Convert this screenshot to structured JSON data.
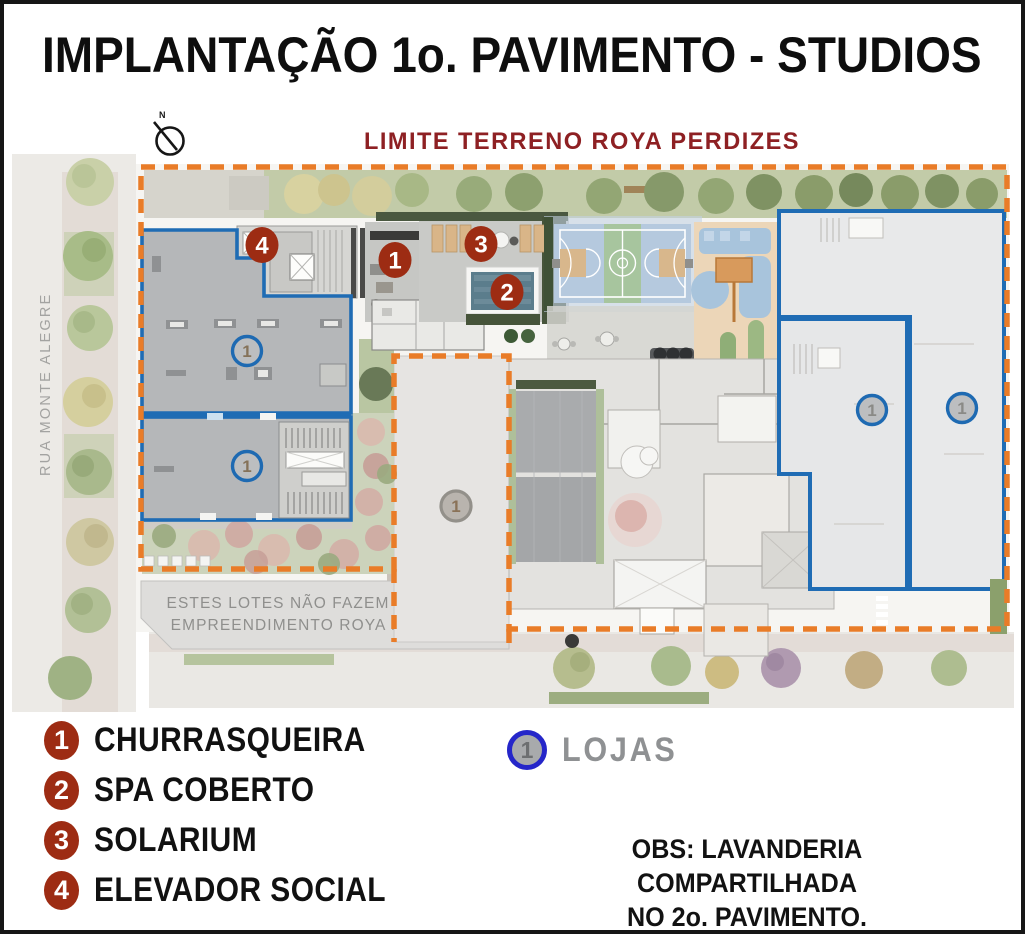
{
  "page": {
    "title": "IMPLANTAÇÃO 1o. PAVIMENTO - STUDIOS"
  },
  "plan": {
    "north_label": "N",
    "boundary_label": "LIMITE TERRENO ROYA PERDIZES",
    "street_label": "RUA MONTE ALEGRE",
    "excluded_note": {
      "line1": "ESTES LOTES NÃO FAZEM PARTE DO",
      "line2": "EMPREENDIMENTO ROYA PERDIZES"
    },
    "red_markers": [
      {
        "number": "4"
      },
      {
        "number": "1"
      },
      {
        "number": "3"
      },
      {
        "number": "2"
      }
    ],
    "shop_markers": [
      {
        "number": "1"
      },
      {
        "number": "1"
      },
      {
        "number": "1"
      },
      {
        "number": "1"
      }
    ],
    "lot_marker": {
      "number": "1"
    }
  },
  "legend": {
    "items": [
      {
        "number": "1",
        "label": "CHURRASQUEIRA"
      },
      {
        "number": "2",
        "label": "SPA COBERTO"
      },
      {
        "number": "3",
        "label": "SOLARIUM"
      },
      {
        "number": "4",
        "label": "ELEVADOR SOCIAL"
      }
    ],
    "lojas": {
      "number": "1",
      "label": "LOJAS"
    },
    "obs": {
      "line1": "OBS: LAVANDERIA COMPARTILHADA",
      "line2": "NO 2o. PAVIMENTO."
    }
  },
  "colors": {
    "marker_red": "#9d2c13",
    "building_outline_blue": "#1f6cb4",
    "lojas_ring_blue": "#2526c9",
    "boundary_orange": "#e97c28",
    "limit_label_maroon": "#8e2023",
    "building_gray": "#b5b7b9"
  }
}
